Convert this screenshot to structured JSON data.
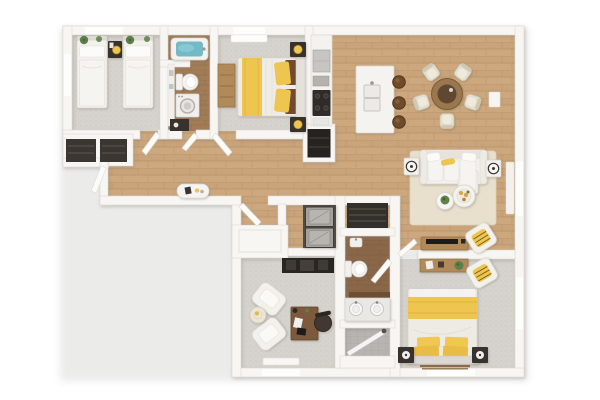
{
  "image": {
    "kind": "3d-floor-plan-render-top-down",
    "description": "Photoreal 3D overhead floor plan of a two-wing apartment with yellow accent bedding, wood open-plan living area and gray carpeted bedrooms",
    "background": "#ffffff"
  },
  "palette": {
    "pageBg": "#ffffff",
    "wall": "#f7f6f3",
    "wallEdge": "#dcd8d2",
    "woodLight": "#cda87e",
    "woodSeam": "#b28c61",
    "woodMid": "#a17c57",
    "woodMidSeam": "#8a6644",
    "woodDark2": "#8b674a",
    "woodDark2Seam": "#73553a",
    "carpet": "#d6d3ce",
    "carpetDot": "#c9c6c1",
    "tile": "#b7b4b1",
    "tileLine": "#a6a3a0",
    "furnWhite": "#f3f1ec",
    "furnWhiteEdge": "#d9d5cf",
    "furnDark": "#37322d",
    "furnWood": "#b08a5a",
    "accentYellow": "#eec54f",
    "teal": "#72bac6",
    "plantGreen": "#5d7f4a",
    "rug": "#eae3d2",
    "applianceGray": "#a5a29e",
    "applianceDark": "#4a4440",
    "cream": "#e3decd"
  },
  "rooms": [
    {
      "id": "bedroom-1",
      "label": "Bedroom with twin beds",
      "floor": "carpet",
      "furniture": [
        "twin bed",
        "twin bed",
        "shared nightstand with yellow lamp",
        "potted plants on headboards",
        "built-in dark closets"
      ]
    },
    {
      "id": "bathroom-1",
      "label": "Bathroom",
      "floor": "wood",
      "furniture": [
        "teal bathtub",
        "toilet",
        "washing machine",
        "dark storage cabinet",
        "wall shelf"
      ]
    },
    {
      "id": "bedroom-2",
      "label": "Bedroom",
      "floor": "carpet",
      "furniture": [
        "double bed with yellow runner and pillows",
        "wood dresser",
        "nightstand with yellow lamp",
        "nightstand with yellow lamp"
      ]
    },
    {
      "id": "kitchen",
      "label": "Kitchen",
      "floor": "wood",
      "furniture": [
        "counter run",
        "refrigerator",
        "cooktop",
        "pantry cabinet",
        "island with double sink",
        "bar stools x3"
      ]
    },
    {
      "id": "dining-area",
      "label": "Dining area",
      "floor": "wood",
      "furniture": [
        "round wood dining table",
        "cream dining chairs x5"
      ]
    },
    {
      "id": "living-room",
      "label": "Living room",
      "floor": "wood",
      "furniture": [
        "white sofa with yellow bolster",
        "side tables with lamps x2",
        "round coffee table with plant",
        "round coffee table with tray",
        "area rug",
        "wood tv console",
        "accent chair with yellow cushion",
        "wall thermostat"
      ]
    },
    {
      "id": "hallway",
      "label": "Hallway",
      "floor": "wood",
      "furniture": [
        "oval console table"
      ]
    },
    {
      "id": "entry",
      "label": "Entry",
      "floor": "wood",
      "furniture": [
        "entry door leaf",
        "wall closet"
      ]
    },
    {
      "id": "laundry",
      "label": "Laundry room",
      "floor": "wood",
      "furniture": [
        "washer",
        "dryer"
      ]
    },
    {
      "id": "linen-closet",
      "label": "Closet",
      "floor": "wood",
      "furniture": [
        "dark shelving"
      ]
    },
    {
      "id": "bathroom-2",
      "label": "Bathroom",
      "floor": "dark wood + tile",
      "furniture": [
        "wall sink",
        "toilet",
        "double-sink vanity",
        "walk-in shower with glass door"
      ]
    },
    {
      "id": "office",
      "label": "Office / den",
      "floor": "carpet",
      "furniture": [
        "white armchairs x2",
        "round side table",
        "wood desk",
        "dark office chair",
        "dark media shelf"
      ]
    },
    {
      "id": "master-bedroom",
      "label": "Master bedroom",
      "floor": "carpet",
      "furniture": [
        "double bed with yellow blanket and yellow pillows",
        "dark nightstands with white lamps x2",
        "wood desk with plant",
        "accent chair with striped yellow cushion"
      ]
    }
  ]
}
